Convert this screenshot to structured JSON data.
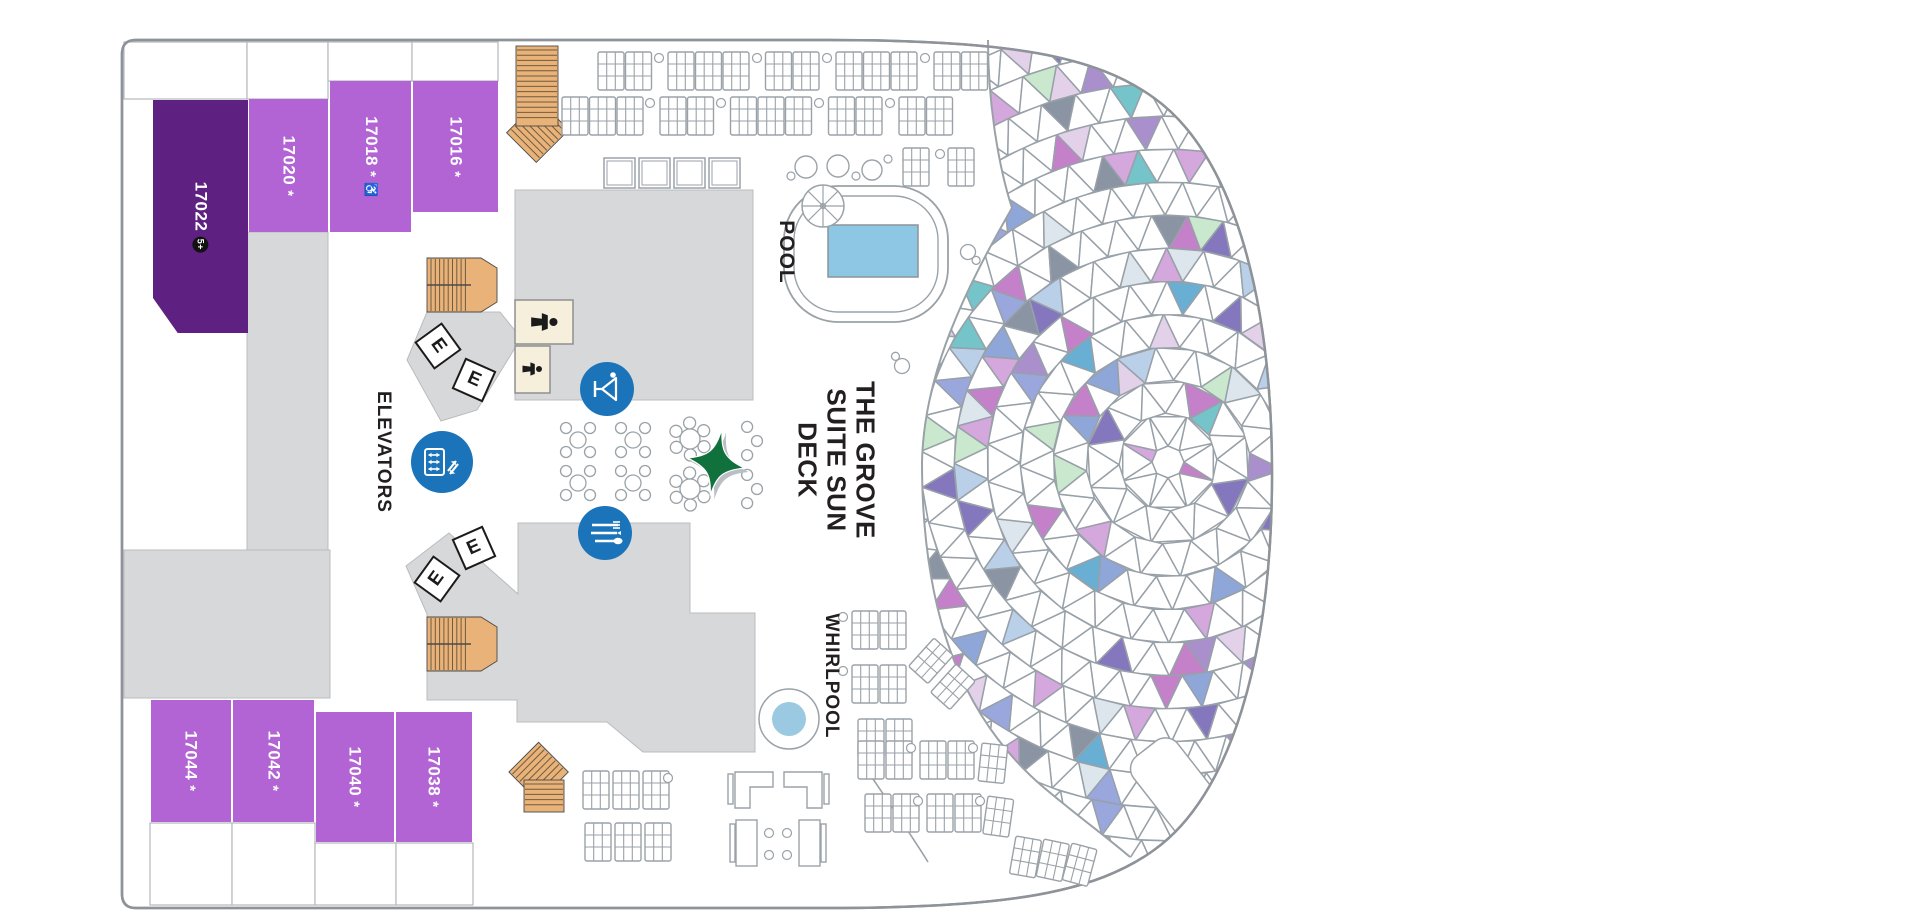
{
  "plan": {
    "cabins": [
      {
        "number": "17022",
        "badge": "5+"
      },
      {
        "number": "17020",
        "star": "*"
      },
      {
        "number": "17018",
        "star": "*",
        "accessible": "♿"
      },
      {
        "number": "17016",
        "star": "*"
      },
      {
        "number": "17044",
        "star": "*"
      },
      {
        "number": "17042",
        "star": "*"
      },
      {
        "number": "17040",
        "star": "*"
      },
      {
        "number": "17038",
        "star": "*"
      }
    ],
    "labels": {
      "pool": "POOL",
      "deck_line1": "THE GROVE",
      "deck_line2": "SUITE SUN",
      "deck_line3": "DECK",
      "elevators": "ELEVATORS",
      "whirlpool": "WHIRLPOOL",
      "elevator_letter": "E"
    },
    "colors": {
      "cabin": "#b263d4",
      "cabin_premium": "#5e2181",
      "deck_gray": "#d7d8da",
      "deck_edge": "#b9bcbf",
      "hull_stroke": "#8e9399",
      "stairs_tan": "#e9b279",
      "stairs_line": "#6f5b3f",
      "icon_blue": "#1b74ba",
      "pool_blue": "#8ec7e4",
      "whirlpool_blue": "#9cc9e2",
      "star_green": "#11713c",
      "furniture_stroke": "#9aa2a8",
      "restroom_cream": "#f6efdc",
      "mosaic_line": "#98a0a8",
      "mosaic_palette": [
        "#b9d0e8",
        "#69aed3",
        "#8fa6d8",
        "#8577bd",
        "#a98fcc",
        "#d4a7dd",
        "#c9e8cd",
        "#8b94a2",
        "#dde6ec",
        "#74c4c9",
        "#9aa7dd",
        "#c481c9",
        "#e3d1ea"
      ]
    }
  }
}
